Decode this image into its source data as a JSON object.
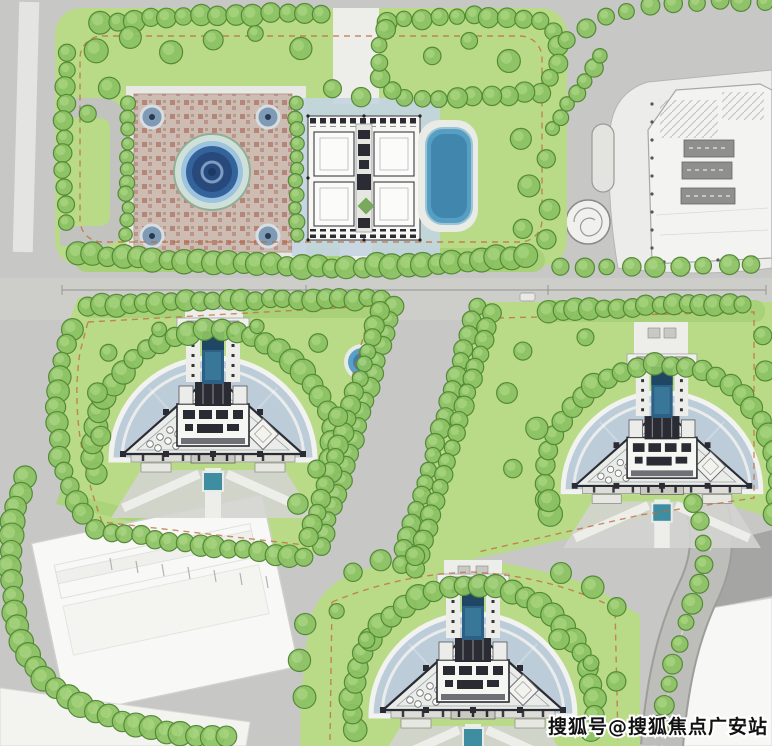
{
  "watermark": {
    "text": "搜狐号@搜狐焦点广安站"
  },
  "palette": {
    "road-gray": "#c7c7c5",
    "road-light": "#d3d3d0",
    "path-white": "#edeeea",
    "lawn": "#b9db88",
    "lawn-light": "#cfe8a6",
    "hedge": "#a9d179",
    "tree-fill": "#8cc263",
    "tree-stroke": "#558a38",
    "tree-light": "#b5de8e",
    "paving-blue": "#bccdd9",
    "pool-blue": "#579fc2",
    "pool-dark": "#2e5f85",
    "pool-teal": "#3f8da0",
    "plaza-pink": "#cdbcb2",
    "pattern-red": "#a3584c",
    "bldg-dark": "#2b2b33",
    "bldg-white": "#f7f7f4",
    "site-white": "#ececea",
    "tower-core": "#8f8f8d",
    "fireline": "#bf6a38",
    "dim-line": "#85857f",
    "watermark-fill": "#111111",
    "watermark-stroke": "#ffffff"
  },
  "scene": {
    "tree_rows": [
      {
        "pts": [
          [
            100,
            22
          ],
          [
            210,
            15
          ],
          [
            325,
            13
          ]
        ],
        "step": 17,
        "r": 10
      },
      {
        "pts": [
          [
            388,
            21
          ],
          [
            470,
            16
          ],
          [
            542,
            20
          ],
          [
            558,
            38
          ],
          [
            557,
            70
          ],
          [
            543,
            92
          ],
          [
            470,
            98
          ],
          [
            398,
            98
          ],
          [
            380,
            78
          ],
          [
            378,
            42
          ],
          [
            390,
            24
          ]
        ],
        "step": 17,
        "r": 9
      },
      {
        "pts": [
          [
            68,
            52
          ],
          [
            63,
            150
          ],
          [
            66,
            238
          ]
        ],
        "step": 17,
        "r": 9
      },
      {
        "pts": [
          [
            78,
            254
          ],
          [
            200,
            262
          ],
          [
            340,
            268
          ],
          [
            462,
            262
          ],
          [
            542,
            254
          ]
        ],
        "step": 15,
        "r": 11
      },
      {
        "pts": [
          [
            552,
            130
          ],
          [
            572,
            99
          ],
          [
            590,
            72
          ],
          [
            607,
            46
          ]
        ],
        "step": 15,
        "r": 8
      },
      {
        "pts": [
          [
            127,
            104
          ],
          [
            127,
            238
          ]
        ],
        "step": 13,
        "r": 7
      },
      {
        "pts": [
          [
            296,
            104
          ],
          [
            296,
            238
          ]
        ],
        "step": 13,
        "r": 7
      },
      {
        "pts": [
          [
            560,
            268
          ],
          [
            768,
            265
          ]
        ],
        "step": 24,
        "r": 9
      },
      {
        "pts": [
          [
            566,
            40
          ],
          [
            592,
            24
          ],
          [
            622,
            11
          ],
          [
            658,
            5
          ],
          [
            702,
            2
          ],
          [
            748,
            1
          ],
          [
            770,
            1
          ]
        ],
        "step": 23,
        "r": 9
      },
      {
        "pts": [
          [
            88,
            306
          ],
          [
            200,
            301
          ],
          [
            300,
            299
          ],
          [
            388,
            299
          ]
        ],
        "step": 14,
        "r": 10
      },
      {
        "pts": [
          [
            72,
            330
          ],
          [
            60,
            370
          ],
          [
            56,
            412
          ],
          [
            60,
            455
          ],
          [
            70,
            492
          ],
          [
            86,
            520
          ]
        ],
        "step": 16,
        "r": 10
      },
      {
        "pts": [
          [
            96,
            530
          ],
          [
            180,
            542
          ],
          [
            258,
            552
          ],
          [
            308,
            558
          ]
        ],
        "step": 15,
        "r": 10
      },
      {
        "arc": [
          213,
          450,
          120,
          192,
          -12
        ],
        "step": 16,
        "r": 11
      },
      {
        "pts": [
          [
            548,
            312
          ],
          [
            640,
            306
          ],
          [
            756,
            303
          ]
        ],
        "step": 14,
        "r": 10
      },
      {
        "arc": [
          662,
          482,
          117,
          196,
          -16
        ],
        "step": 16,
        "r": 11
      },
      {
        "arc": [
          473,
          706,
          121,
          192,
          -12
        ],
        "step": 16,
        "r": 11
      },
      {
        "pts": [
          [
            394,
            306
          ],
          [
            355,
            436
          ],
          [
            319,
            554
          ]
        ],
        "step": 14,
        "r": 9
      },
      {
        "pts": [
          [
            379,
            311
          ],
          [
            341,
            440
          ],
          [
            306,
            546
          ]
        ],
        "step": 14,
        "r": 9
      },
      {
        "pts": [
          [
            476,
            308
          ],
          [
            437,
            440
          ],
          [
            399,
            570
          ]
        ],
        "step": 14,
        "r": 9
      },
      {
        "pts": [
          [
            491,
            313
          ],
          [
            452,
            446
          ],
          [
            412,
            578
          ]
        ],
        "step": 14,
        "r": 9
      },
      {
        "pts": [
          [
            24,
            478
          ],
          [
            14,
            520
          ],
          [
            10,
            565
          ],
          [
            13,
            608
          ],
          [
            22,
            645
          ],
          [
            40,
            675
          ],
          [
            66,
            696
          ],
          [
            98,
            712
          ],
          [
            132,
            724
          ],
          [
            170,
            732
          ],
          [
            206,
            736
          ],
          [
            236,
            737
          ]
        ],
        "step": 15,
        "r": 11
      },
      {
        "pts": [
          [
            692,
            502
          ],
          [
            702,
            530
          ],
          [
            704,
            562
          ],
          [
            697,
            592
          ],
          [
            684,
            625
          ],
          [
            674,
            658
          ],
          [
            666,
            695
          ],
          [
            660,
            730
          ]
        ],
        "step": 21,
        "r": 9
      }
    ],
    "trees": [
      [
        95,
        50,
        11
      ],
      [
        130,
        38,
        10
      ],
      [
        170,
        52,
        10
      ],
      [
        108,
        88,
        10
      ],
      [
        88,
        115,
        9
      ],
      [
        212,
        40,
        9
      ],
      [
        256,
        33,
        9
      ],
      [
        300,
        47,
        10
      ],
      [
        331,
        90,
        10
      ],
      [
        361,
        98,
        9
      ],
      [
        432,
        55,
        10
      ],
      [
        470,
        42,
        9
      ],
      [
        508,
        60,
        10
      ],
      [
        520,
        138,
        10
      ],
      [
        546,
        158,
        10
      ],
      [
        528,
        185,
        10
      ],
      [
        550,
        208,
        10
      ],
      [
        522,
        228,
        9
      ],
      [
        547,
        240,
        9
      ],
      [
        318,
        342,
        10
      ],
      [
        338,
        418,
        10
      ],
      [
        318,
        468,
        10
      ],
      [
        298,
        505,
        10
      ],
      [
        108,
        352,
        9
      ],
      [
        96,
        394,
        9
      ],
      [
        102,
        437,
        9
      ],
      [
        160,
        328,
        8
      ],
      [
        256,
        326,
        8
      ],
      [
        524,
        352,
        10
      ],
      [
        506,
        392,
        10
      ],
      [
        536,
        428,
        10
      ],
      [
        512,
        468,
        10
      ],
      [
        548,
        500,
        10
      ],
      [
        584,
        338,
        9
      ],
      [
        762,
        336,
        9
      ],
      [
        766,
        372,
        9
      ],
      [
        352,
        572,
        10
      ],
      [
        382,
        561,
        10
      ],
      [
        414,
        555,
        9
      ],
      [
        562,
        572,
        10
      ],
      [
        592,
        588,
        10
      ],
      [
        618,
        608,
        10
      ],
      [
        306,
        625,
        10
      ],
      [
        298,
        660,
        10
      ],
      [
        304,
        696,
        10
      ],
      [
        560,
        640,
        9
      ],
      [
        590,
        662,
        9
      ],
      [
        616,
        682,
        9
      ],
      [
        366,
        640,
        8
      ],
      [
        336,
        610,
        8
      ]
    ]
  }
}
